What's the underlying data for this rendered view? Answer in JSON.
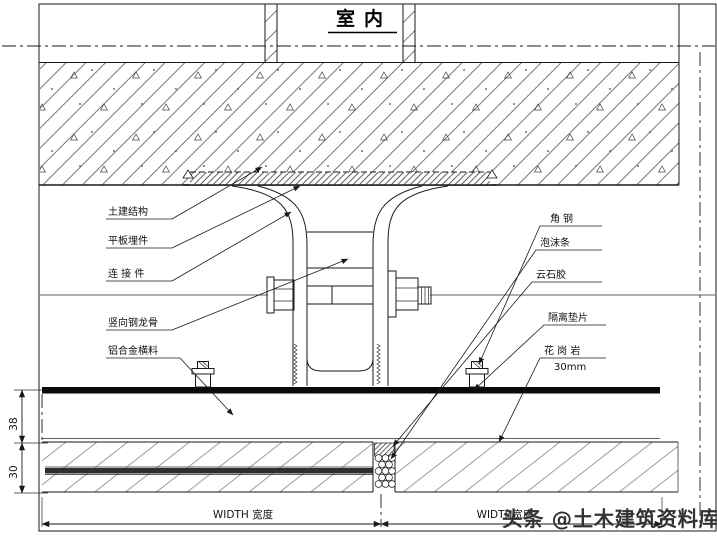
{
  "title": "室内",
  "drawing": {
    "labels_left": [
      {
        "text": "土建结构"
      },
      {
        "text": "平板埋件"
      },
      {
        "text": "连 接 件"
      },
      {
        "text": "竖向钢龙骨"
      },
      {
        "text": "铝合金横料"
      }
    ],
    "labels_right": [
      {
        "text": "角钢"
      },
      {
        "text": "泡沫条"
      },
      {
        "text": "云石胶"
      },
      {
        "text": "隔离垫片"
      },
      {
        "text": "花 岗 岩"
      },
      {
        "text": "30mm"
      }
    ],
    "dimensions": {
      "air_gap": "38",
      "stone_thickness": "30",
      "width_bottom_left": "WIDTH 宽度",
      "width_bottom_right": "WIDTH宽度"
    }
  },
  "watermark": {
    "text": "头条 @土木建筑资料库"
  },
  "colors": {
    "line": "#1a1a1a",
    "hatch": "#555555",
    "rail": "#0a0a0a",
    "watermark": "#333333"
  }
}
